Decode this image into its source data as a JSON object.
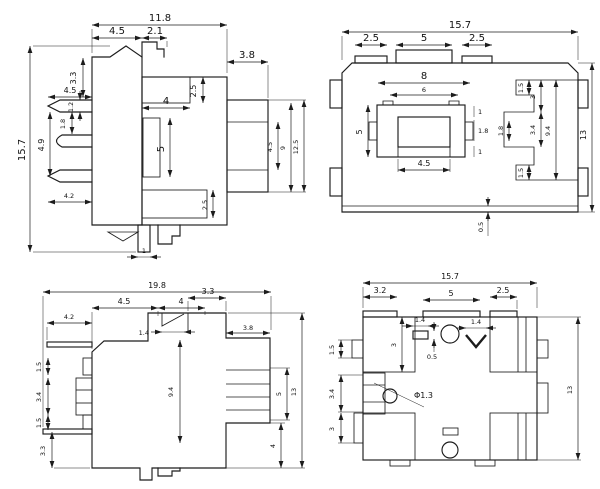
{
  "views": {
    "side": {
      "dims": {
        "total_w": "11.8",
        "top_a": "4.5",
        "top_b": "2.1",
        "ext_w": "3.8",
        "total_h": "15.7",
        "pin_top": "3.3",
        "pin_len": "4.5",
        "pin_t": "1.2",
        "pin_gap": "1.8",
        "pin_pitch": "4.9",
        "pin_bot": "4.2",
        "inner_w": "4",
        "inner_h": "5",
        "step_top": "2.5",
        "step_bot": "2.5",
        "ext_a": "4.5",
        "ext_b": "9",
        "ext_c": "12.5",
        "peg_w": "1"
      }
    },
    "top": {
      "dims": {
        "total_w": "15.7",
        "tab_l": "2.5",
        "tab_c": "5",
        "tab_r": "2.5",
        "in_w1": "8",
        "in_w2": "6",
        "frame_h": "5",
        "btn_w": "4.5",
        "n1": "1",
        "n2": "1.8",
        "n3": "1",
        "r_a": "1.5",
        "r_b": "3",
        "r_c": "1.8",
        "r_d": "3.4",
        "r_e": "9.4",
        "r_f": "1.5",
        "total_h": "13",
        "bot_off": "0.5"
      }
    },
    "side2": {
      "dims": {
        "total_w": "19.8",
        "lead_top": "4.2",
        "top_a": "4.5",
        "top_b": "4",
        "top_c": "3.3",
        "notch_w": "1.4",
        "l_a": "1.5",
        "l_b": "3.4",
        "l_c": "1.5",
        "l_d": "3.3",
        "body_h": "9.4",
        "ext_w": "3.8",
        "pin_h": "5",
        "bot_h": "4",
        "total_h": "13"
      }
    },
    "bottom": {
      "dims": {
        "total_w": "15.7",
        "tab_l": "3.2",
        "tab_c": "5",
        "tab_r": "2.5",
        "slot_w": "1.4",
        "slot_off": "0.5",
        "chev_w": "1.4",
        "recess_d": "3",
        "hole_dia": "Φ1.3",
        "l_a": "1.5",
        "l_b": "3.4",
        "l_c": "3",
        "total_h": "13"
      }
    }
  }
}
